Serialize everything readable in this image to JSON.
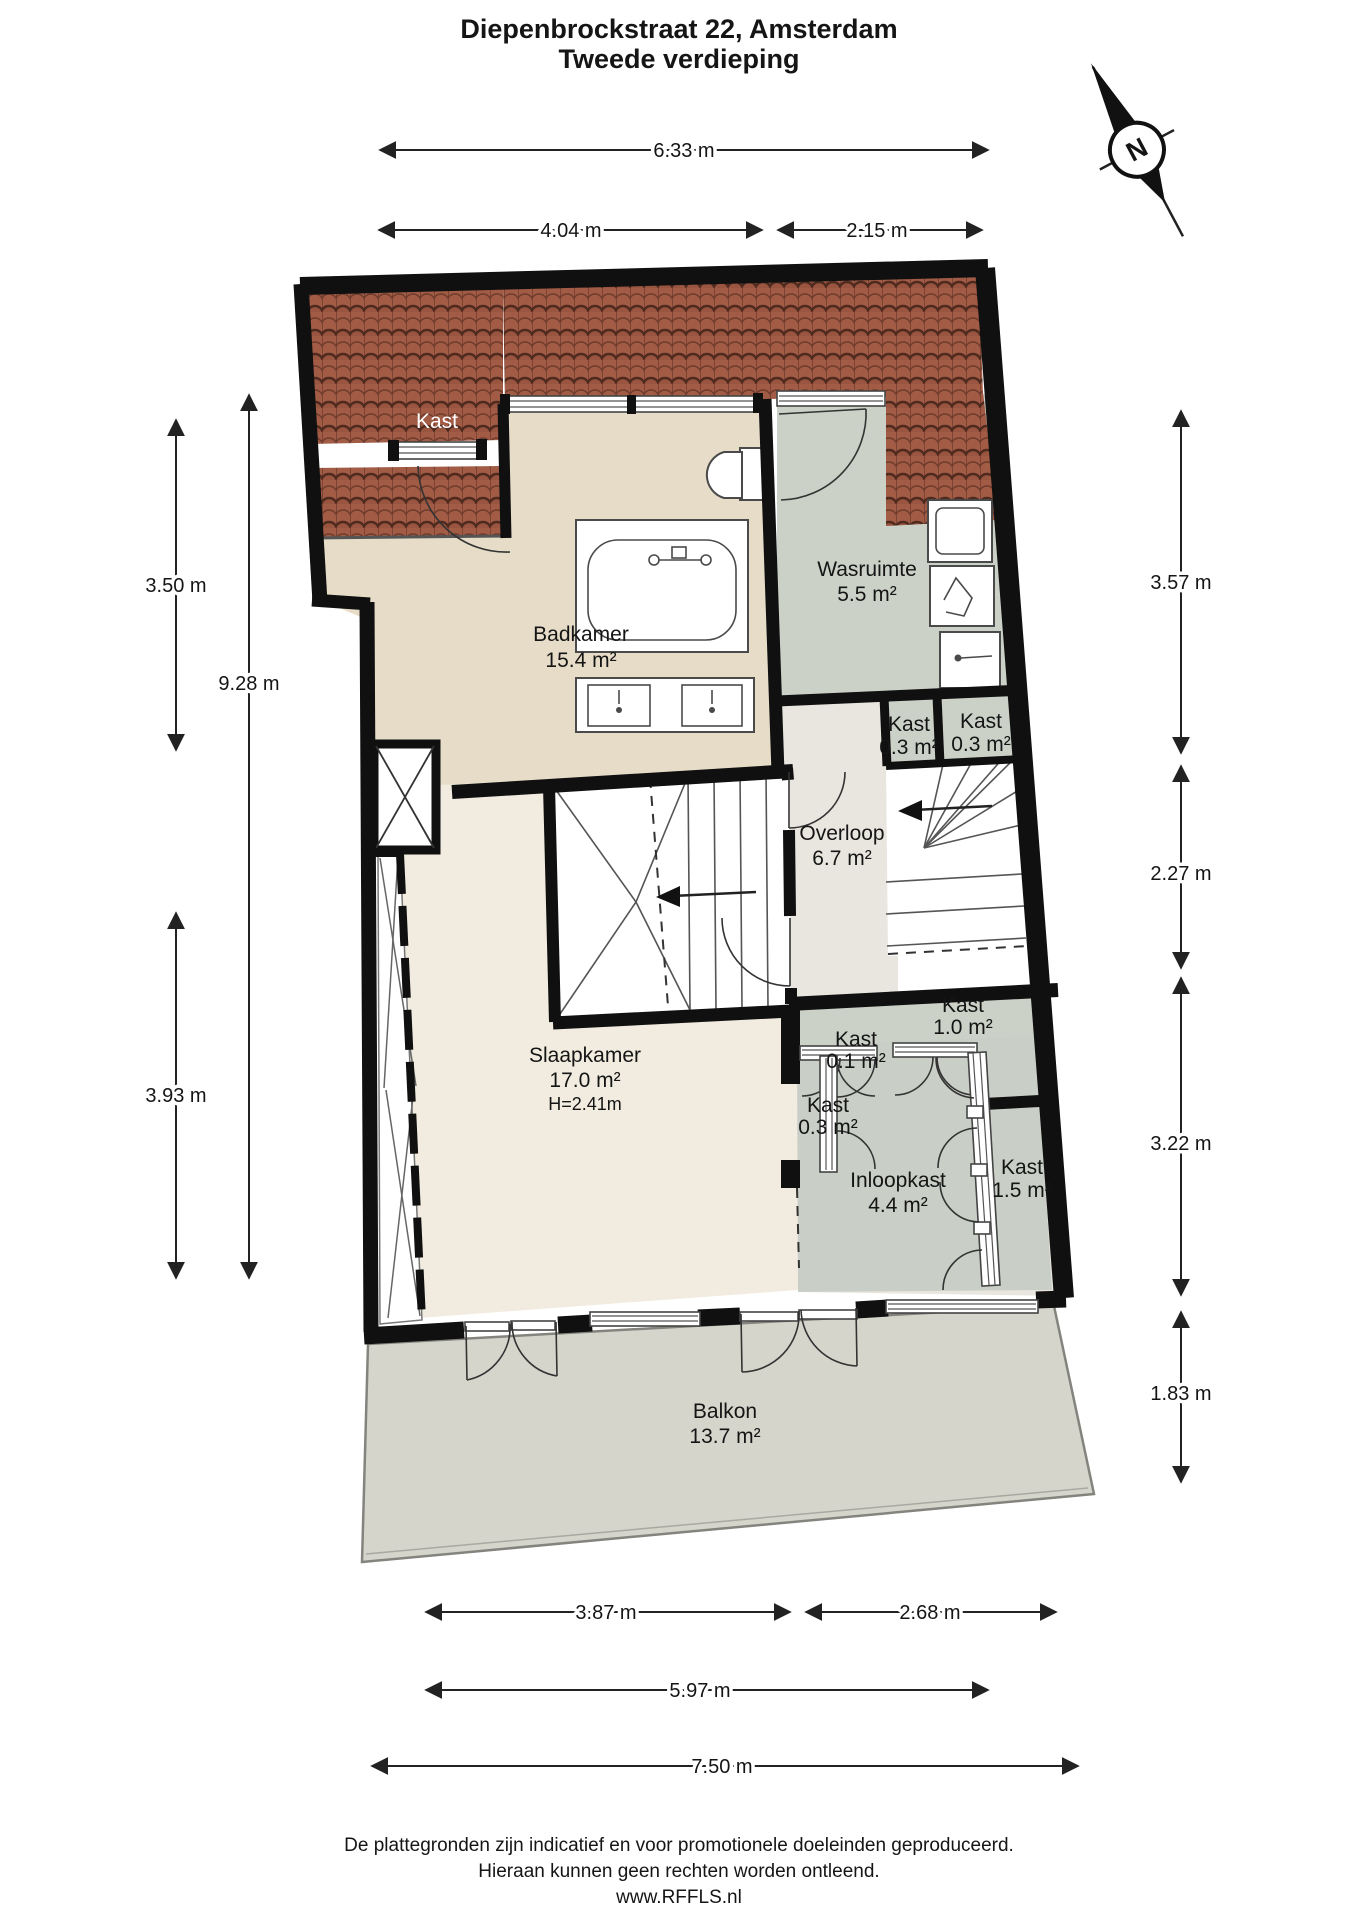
{
  "title": {
    "line1": "Diepenbrockstraat 22, Amsterdam",
    "line2": "Tweede verdieping"
  },
  "compass": {
    "north_label": "N"
  },
  "dimensions": {
    "top": [
      {
        "label": "6.33 m"
      }
    ],
    "upper": [
      {
        "label": "4.04 m"
      },
      {
        "label": "2.15 m"
      }
    ],
    "left": [
      {
        "label": "3.50 m"
      },
      {
        "label": "9.28 m"
      },
      {
        "label": "3.93 m"
      }
    ],
    "right": [
      {
        "label": "3.57 m"
      },
      {
        "label": "2.27 m"
      },
      {
        "label": "3.22 m"
      },
      {
        "label": "1.83 m"
      }
    ],
    "bottom": [
      {
        "label": "3.87 m"
      },
      {
        "label": "2.68 m"
      },
      {
        "label": "5.97 m"
      },
      {
        "label": "7.50 m"
      }
    ]
  },
  "rooms": {
    "kast_attic": {
      "name": "Kast"
    },
    "badkamer": {
      "name": "Badkamer",
      "area": "15.4 m²"
    },
    "wasruimte": {
      "name": "Wasruimte",
      "area": "5.5 m²"
    },
    "kast_boven_links": {
      "name": "Kast",
      "area": "0.3 m²"
    },
    "kast_boven_rechts": {
      "name": "Kast",
      "area": "0.3 m²"
    },
    "overloop": {
      "name": "Overloop",
      "area": "6.7 m²"
    },
    "kast_1_0": {
      "name": "Kast",
      "area": "1.0 m²"
    },
    "kast_0_1": {
      "name": "Kast",
      "area": "0.1 m²"
    },
    "kast_0_3": {
      "name": "Kast",
      "area": "0.3 m²"
    },
    "slaapkamer": {
      "name": "Slaapkamer",
      "area": "17.0 m²",
      "height": "H=2.41m"
    },
    "inloopkast": {
      "name": "Inloopkast",
      "area": "4.4 m²"
    },
    "kast_1_5": {
      "name": "Kast",
      "area": "1.5 m²"
    },
    "balkon": {
      "name": "Balkon",
      "area": "13.7 m²"
    }
  },
  "footer": {
    "line1": "De plattegronden zijn indicatief en voor promotionele doeleinden geproduceerd.",
    "line2": "Hieraan kunnen geen rechten worden ontleend.",
    "line3": "www.RFFLS.nl"
  },
  "colors": {
    "wall": "#101010",
    "badkamer_floor": "#e6dcc8",
    "slaapkamer_floor": "#f1ecdf",
    "overloop_floor": "#e9e6df",
    "closet_floor": "#cbd1c7",
    "balkon_floor": "#d6d5cc",
    "roof_tile": "#a25b45",
    "roof_tile_dark": "#4f2a1e"
  }
}
